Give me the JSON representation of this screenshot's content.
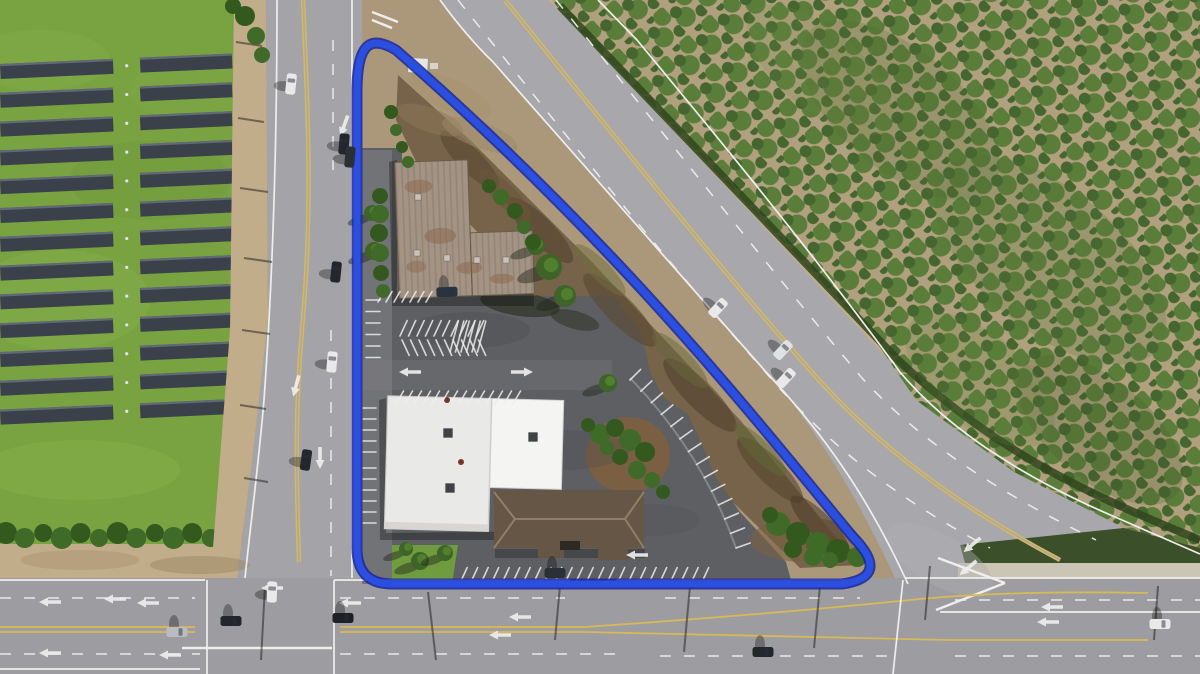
{
  "annotation": {
    "label": "parcel-boundary",
    "shape": "rounded-triangle",
    "color": "#2b4fe0",
    "edge_color": "#18269e"
  },
  "colors": {
    "base_dirt": "#ab987a",
    "grass": "#79a341",
    "panel": "#3a414b",
    "panel_edge": "#707a88",
    "hedge": "#35511f",
    "shoulder": "#c2ad8b",
    "road": "#a8a8ac",
    "road_minor": "#a4a4a8",
    "road_bottom": "#9d9da1",
    "asphalt": "#5d5f63",
    "asphalt_light": "#87888c",
    "concrete": "#cbc5b5",
    "orchard_base": "#b0a07e",
    "orchard_tree": "#5b7d3a",
    "orchard_tree_dark": "#466630",
    "orchard_edge": "#30451d",
    "scrub": "#77634a",
    "roof_metal": "#a29384",
    "roof_metal_rust": "#8a6248",
    "roof_white_a": "#e9e9e7",
    "roof_white_b": "#f4f4f2",
    "roof_brown": "#655646",
    "roof_brown_ridge": "#907e66",
    "lawn": "#6f9c3e",
    "bush": "#3f6a28",
    "bush_dark": "#34591f",
    "mulch": "#7a5f43",
    "white_line": "#eeeeec",
    "yellow_line": "#d9b954",
    "blue": "#2b4fe0",
    "blue_dark": "#18269e"
  },
  "scene": {
    "solar": {
      "x0": 0,
      "x1": 232,
      "gapA": 113,
      "gapB": 140,
      "y0": 64,
      "dy": 28.8,
      "rows": 13,
      "h": 15,
      "tilt": -2.6
    },
    "hedge": {
      "x0": 6,
      "x1": 248,
      "n": 14,
      "y": 535,
      "r": 11
    },
    "blobs_under": [
      [
        60,
        300,
        90,
        50,
        0,
        "#86b14c",
        0.35
      ],
      [
        150,
        180,
        80,
        40,
        0,
        "#6d9638",
        0.3
      ],
      [
        80,
        470,
        100,
        30,
        0,
        "#8ab54e",
        0.35
      ],
      [
        190,
        90,
        60,
        30,
        0,
        "#82ad49",
        0.3
      ],
      [
        40,
        60,
        70,
        30,
        0,
        "#89b450",
        0.3
      ]
    ],
    "blobs": [
      [
        470,
        160,
        40,
        12,
        45,
        "#5a4730",
        0.6
      ],
      [
        540,
        230,
        45,
        13,
        45,
        "#52402c",
        0.55
      ],
      [
        620,
        310,
        50,
        14,
        45,
        "#5a4830",
        0.6
      ],
      [
        700,
        395,
        50,
        14,
        45,
        "#4f3e2a",
        0.55
      ],
      [
        770,
        470,
        45,
        13,
        45,
        "#56442e",
        0.6
      ],
      [
        820,
        525,
        40,
        12,
        45,
        "#4c3b28",
        0.55
      ],
      [
        600,
        270,
        35,
        10,
        45,
        "#6e6d3e",
        0.5
      ],
      [
        680,
        360,
        38,
        11,
        45,
        "#67683a",
        0.5
      ],
      [
        760,
        450,
        36,
        10,
        45,
        "#5f6a35",
        0.5
      ],
      [
        505,
        195,
        35,
        11,
        45,
        "#6b5639",
        0.55
      ],
      [
        450,
        95,
        45,
        16,
        25,
        "#a8946f",
        0.55
      ],
      [
        430,
        120,
        35,
        12,
        20,
        "#8d7856",
        0.5
      ],
      [
        480,
        135,
        40,
        13,
        20,
        "#9c8868",
        0.5
      ],
      [
        900,
        110,
        120,
        60,
        40,
        "#4e6b31",
        0.22
      ],
      [
        1050,
        260,
        140,
        70,
        40,
        "#537035",
        0.22
      ],
      [
        820,
        70,
        90,
        40,
        40,
        "#6d8b47",
        0.18
      ],
      [
        1100,
        430,
        100,
        50,
        40,
        "#42582a",
        0.22
      ],
      [
        980,
        380,
        90,
        45,
        40,
        "#5d7c3e",
        0.2
      ],
      [
        470,
        330,
        60,
        18,
        0,
        "#4a4c50",
        0.35
      ],
      [
        560,
        450,
        70,
        20,
        0,
        "#4a4c50",
        0.3
      ],
      [
        650,
        520,
        50,
        16,
        0,
        "#515357",
        0.3
      ],
      [
        80,
        560,
        60,
        10,
        0,
        "#a9936f",
        0.5
      ],
      [
        200,
        565,
        50,
        9,
        0,
        "#9c8766",
        0.5
      ],
      [
        940,
        560,
        60,
        25,
        30,
        "#b0b0b4",
        0.4
      ],
      [
        520,
        304,
        40,
        12,
        8,
        "#272b1d",
        0.6
      ],
      [
        575,
        320,
        25,
        9,
        15,
        "#2b2f20",
        0.5
      ]
    ],
    "stripe_groups": [
      [
        400,
        336,
        10,
        8.5,
        0,
        -65,
        17
      ],
      [
        402,
        340,
        10,
        8.5,
        0,
        65,
        17
      ],
      [
        450,
        352,
        6,
        5.5,
        0,
        -75,
        32
      ],
      [
        396,
        404,
        14,
        9,
        0,
        -60,
        15
      ],
      [
        366,
        300,
        6,
        0,
        11.5,
        0,
        14
      ],
      [
        363,
        408,
        5,
        0,
        11,
        0,
        13
      ],
      [
        363,
        468,
        6,
        0,
        11,
        0,
        13
      ],
      [
        378,
        302,
        7,
        8,
        0,
        -60,
        12
      ],
      [
        460,
        583,
        24,
        10.5,
        0,
        -65,
        17
      ]
    ],
    "arc_stripes": {
      "p0": [
        630,
        380
      ],
      "p1": [
        702,
        452
      ],
      "p2": [
        736,
        548
      ],
      "n": 14,
      "len": 15
    },
    "trees": [
      [
        549,
        267,
        13
      ],
      [
        565,
        296,
        11
      ],
      [
        536,
        246,
        9
      ],
      [
        372,
        213,
        8
      ],
      [
        374,
        251,
        9
      ],
      [
        608,
        383,
        9
      ],
      [
        420,
        561,
        9
      ],
      [
        445,
        553,
        8
      ],
      [
        406,
        549,
        7
      ]
    ],
    "bushes": [
      [
        380,
        196,
        8
      ],
      [
        380,
        214,
        9
      ],
      [
        379,
        233,
        9
      ],
      [
        380,
        253,
        9
      ],
      [
        381,
        273,
        8
      ],
      [
        383,
        291,
        7
      ],
      [
        391,
        112,
        7
      ],
      [
        396,
        130,
        6
      ],
      [
        402,
        147,
        6
      ],
      [
        408,
        162,
        6
      ],
      [
        489,
        186,
        7
      ],
      [
        501,
        197,
        8
      ],
      [
        515,
        211,
        8
      ],
      [
        524,
        227,
        7
      ],
      [
        533,
        242,
        8
      ],
      [
        600,
        434,
        10
      ],
      [
        615,
        428,
        9
      ],
      [
        630,
        440,
        11
      ],
      [
        645,
        452,
        10
      ],
      [
        637,
        470,
        9
      ],
      [
        620,
        457,
        8
      ],
      [
        652,
        480,
        8
      ],
      [
        663,
        492,
        7
      ],
      [
        607,
        448,
        7
      ],
      [
        588,
        425,
        7
      ],
      [
        778,
        524,
        12
      ],
      [
        798,
        534,
        12
      ],
      [
        818,
        544,
        12
      ],
      [
        838,
        551,
        12
      ],
      [
        857,
        557,
        10
      ],
      [
        793,
        549,
        9
      ],
      [
        813,
        557,
        9
      ],
      [
        770,
        515,
        8
      ],
      [
        830,
        560,
        8
      ],
      [
        245,
        16,
        10
      ],
      [
        256,
        36,
        9
      ],
      [
        233,
        6,
        8
      ],
      [
        262,
        55,
        8
      ]
    ],
    "cars": [
      [
        291,
        84,
        6,
        "#e9e9e9"
      ],
      [
        344,
        144,
        5,
        "#23262b"
      ],
      [
        350,
        157,
        5,
        "#2c3036"
      ],
      [
        336,
        272,
        6,
        "#23262b"
      ],
      [
        332,
        362,
        5,
        "#e9e9e9"
      ],
      [
        306,
        460,
        8,
        "#23262b"
      ],
      [
        272,
        592,
        2,
        "#e9e9e9"
      ],
      [
        231,
        621,
        90,
        "#23262b"
      ],
      [
        177,
        632,
        90,
        "#b9bcc0"
      ],
      [
        343,
        618,
        90,
        "#1d2024"
      ],
      [
        763,
        652,
        90,
        "#23262b"
      ],
      [
        1160,
        624,
        90,
        "#e9e9e9"
      ],
      [
        718,
        308,
        43,
        "#e9e9e9"
      ],
      [
        783,
        350,
        43,
        "#dfe1e3"
      ],
      [
        786,
        378,
        43,
        "#e9e9e9"
      ],
      [
        447,
        292,
        88,
        "#2a3340"
      ],
      [
        555,
        573,
        90,
        "#2c3036"
      ]
    ],
    "arrows": [
      [
        296,
        386,
        -75
      ],
      [
        320,
        458,
        -90
      ],
      [
        344,
        126,
        -70
      ],
      [
        272,
        588,
        0
      ],
      [
        637,
        555,
        0
      ],
      [
        50,
        602,
        0
      ],
      [
        148,
        603,
        0
      ],
      [
        50,
        653,
        0
      ],
      [
        170,
        655,
        0
      ],
      [
        350,
        603,
        0
      ],
      [
        520,
        617,
        0
      ],
      [
        500,
        635,
        0
      ],
      [
        1052,
        607,
        0
      ],
      [
        1048,
        622,
        0
      ],
      [
        972,
        545,
        -40
      ],
      [
        968,
        568,
        -40
      ],
      [
        410,
        372,
        0
      ],
      [
        522,
        372,
        180
      ],
      [
        115,
        599,
        0
      ]
    ],
    "shadow_lines": [
      [
        240,
        188,
        268,
        192
      ],
      [
        244,
        258,
        272,
        262
      ],
      [
        242,
        330,
        270,
        334
      ],
      [
        240,
        405,
        266,
        409
      ],
      [
        244,
        478,
        268,
        482
      ],
      [
        238,
        118,
        264,
        122
      ],
      [
        236,
        42,
        262,
        46
      ],
      [
        690,
        586,
        684,
        652
      ],
      [
        820,
        586,
        814,
        648
      ],
      [
        930,
        566,
        925,
        620
      ],
      [
        265,
        586,
        261,
        660
      ],
      [
        428,
        592,
        436,
        660
      ],
      [
        560,
        586,
        555,
        640
      ],
      [
        1158,
        586,
        1154,
        640
      ]
    ],
    "units": [
      [
        417,
        253,
        6,
        "#c9c2b8"
      ],
      [
        447,
        258,
        6,
        "#c9c2b8"
      ],
      [
        477,
        260,
        6,
        "#c9c2b8"
      ],
      [
        506,
        260,
        6,
        "#c9c2b8"
      ],
      [
        418,
        197,
        6,
        "#c9c2b8"
      ],
      [
        448,
        433,
        9,
        "#3f4347"
      ],
      [
        533,
        437,
        9,
        "#3f4347"
      ],
      [
        450,
        488,
        9,
        "#3f4347"
      ]
    ],
    "vents": [
      [
        447,
        400,
        3
      ],
      [
        461,
        462,
        3
      ]
    ]
  }
}
